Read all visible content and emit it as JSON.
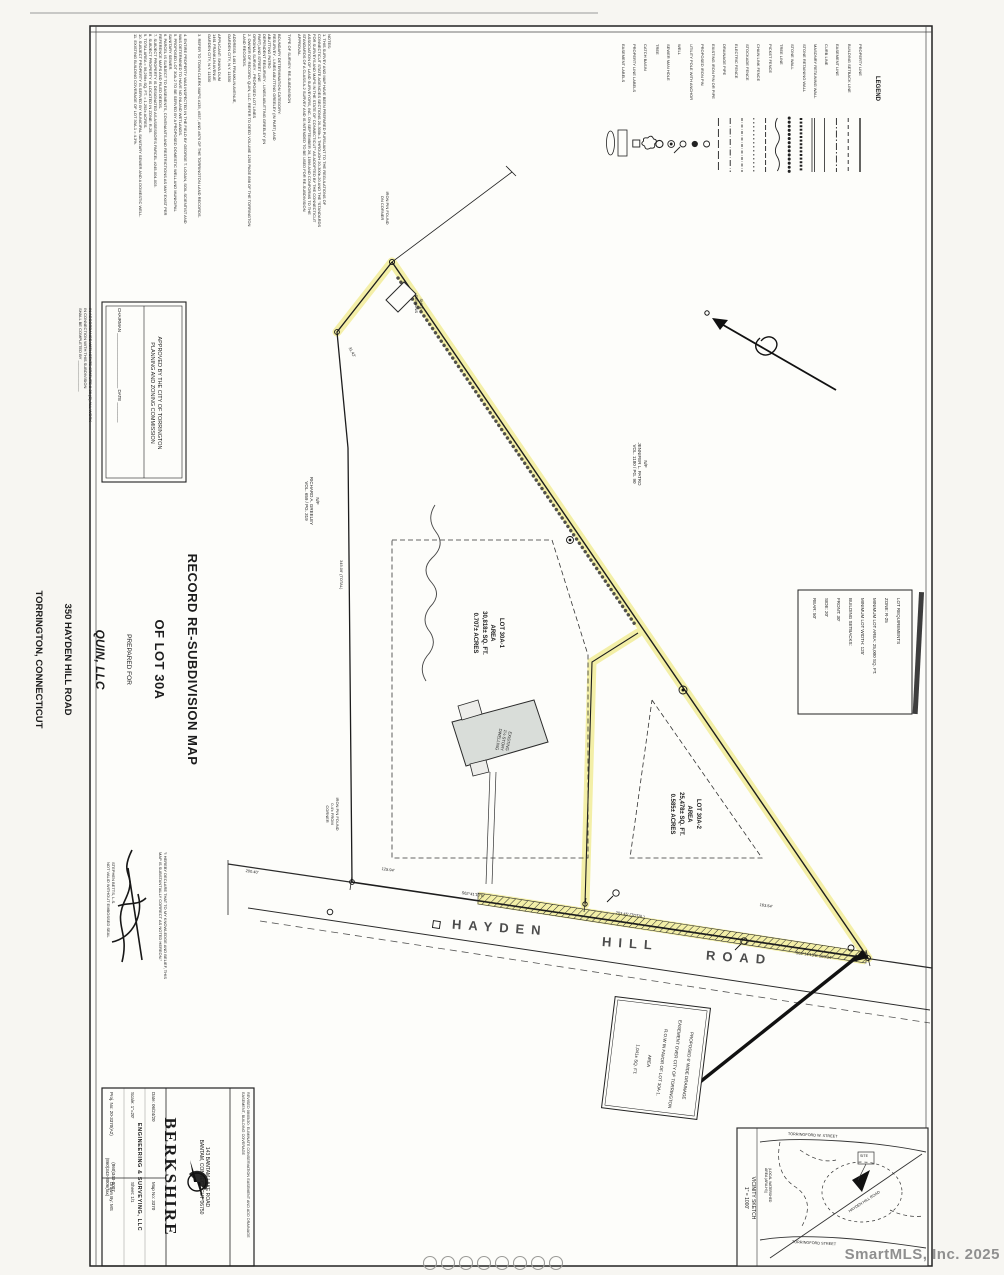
{
  "watermark": "SmartMLS, Inc.  2025",
  "title": {
    "line1": "RECORD RE-SUBDIVISION MAP",
    "line2": "OF LOT 30A",
    "prepared_for": "PREPARED FOR",
    "owner": "QUIN, LLC",
    "address": "350 HAYDEN HILL ROAD",
    "city": "TORRINGTON, CONNECTICUT"
  },
  "legend": {
    "title": "LEGEND",
    "items": "PROPERTY LINE\nBUILDING SETBACK LINE\nEASEMENT LINE\nCURB LINE\nMASONRY RETAINING WALL\nSTONE RETAINING WALL\nSTONE WALL\nTREE LINE\nPICKET FENCE\nCHAIN LINK FENCE\nSTOCKADE FENCE\nELECTRIC FENCE\nDRAINAGE PIPE\nEXISTING IRON PIN OR PIPE\nPROPOSED IRON PIN\nUTILITY POLE WITH ANCHOR\nWELL\nSEWER MAN HOLE\nTREE\nCATCH BASIN\nPROPERTY LINE LABELS\nEASEMENT LABELS"
  },
  "notes_col1": "NOTES:\n1. THIS SURVEY AND MAP HAVE BEEN PREPARED PURSUANT TO THE REGULATIONS OF\nCONNECTICUT STATE AGENCIES SECTIONS 20-300b-1 THROUGH 20-300b-20 AND THE \"STANDARDS\nFOR SURVEYS AND MAPS IN THE STATE OF CONNECTICUT\" AS ADOPTED BY THE CONNECTICUT\nASSOCIATION OF LAND SURVEYORS, INC. ON SEPTEMBER 26, 1996 AND CONFORMS TO THE\nSTANDARDS OF A CLASS A-2 SURVEY AND IS INTENDED TO BE USED FOR RE-SUBDIVISION\nAPPROVAL.\n\nTYPE OF SURVEY:   RE-SUBDIVISION\n\nBOUNDARY DETERMINATION CATEGORY:\n        RESURVEY - LINES ABUTTING GREELEY (IN PART) AND\n        ABUTTING PATRO\n        DEPENDENT RESURVEY - LINES ABUTTING GREELEY (IN\n        PART) AND STREET LINE\n        ORIGINAL SURVEY - PROPOSED LOT LINES",
  "notes_col2": "2. OWNER OF RECORD:  QUIN, LLC. REFER TO DEED VOLUME 1295 PAGE 898 OF THE TORRINGTON\nLAND RECORDS.\n\n        ADDRESS:  1461 FRANKLIN AVENUE,\n        GARDEN CITY, N.Y. 11530\n\n        APPLICANT:  SHAYA DUM\n        1461 FRANKLIN AVENUE\n        GARDEN CITY, N.Y. 11530\n\n3. REFER TO TOWN CLERK MAPS #135, #537, AND #879 OF THE TORRINGTON LAND RECORDS.",
  "notes_col3": "4. ENTIRE PROPERTY WAS INSPECTED IN THE FIELD BY GEORGE T. LOGAN, SOIL SCIENTIST AND\nWAS DETERMINED TO HAVE NO INLAND WETLANDS.\n5. PROPOSED LOT 30A-2 TO BE SERVED BY A PROPOSED DOMESTIC WELL AND MUNICIPAL\nSANITARY SEWER.\n6. PARCEL IS SUBJECT TO EASEMENTS, COVENANTS AND RESTRICTIONS AS MAY EXIST PER\nREFERENCE MAPS AND FILED DEEDS.\n7. SUBJECT PROPERTY IS DESIGNATED AS ASSESSOR'S PARCEL #245-004-003.\n8. SUBJECT PROPERTY IS LOCATED IN ZONE: R-25.\n9. TOTAL AREA = 56,296± SQ. FT. = 1.292± ACRES.\n10. SUBJECT PROPERTY IS SERVED BY MUNICIPAL SANITARY SEWER AND A DOMESTIC WELL.\n11. EXISTING BUILDING COVERAGE OF LOT 30A-1 = 4.3%.",
  "approval": {
    "title": "APPROVED BY THE CITY OF TORRINGTON\nPLANNING AND ZONING COMMISSION",
    "signline": "CHAIRMAN ______________________        DATE ________",
    "note": "IN ACCORDANCE WITH STATE STATUTE 8-26 (C) ALL WORK\nIN CONNECTION WITH THIS SUBDIVISION\nSHALL BE COMPLETED BY ______________"
  },
  "certification": {
    "declaration": "\"I HEREBY DECLARE THAT TO MY KNOWLEDGE AND BELIEF, THIS\nMAP IS SUBSTANTIALLY CORRECT AS NOTED HEREON.\"",
    "name_seal": "STEPHEN BETTS, L.S.\nNOT VALID WITHOUT EMBOSSED SEAL"
  },
  "lot1": "LOT 30A-1\nAREA\n30,818± SQ. FT.\n0.707± ACRES",
  "lot2": "LOT 30A-2\nAREA\n25,478± SQ. FT.\n0.585± ACRES",
  "requirements": "LOT REQUIREMENTS\nZONE:  R-25\nMINIMUM LOT AREA: 25,000 SQ. FT.\nMINIMUM LOT WIDTH: 125'\nBUILDING SETBACKS:\n    FRONT:  30'\n    SIDE:  20'\n    REAR:  50'",
  "drainage_note": "PROPOSED 6' WIDE DRAINAGE\nEASEMENT OVER CITY OF TORRINGTON\nR.O.W IN FAVOR OF LOT 30A-1.\nAREA\n1,041± SQ. FT.",
  "abutters": {
    "patro": "N/F\nJENNIFER L. PATRO\nVOL. 1180 / PG. 90",
    "greeley": "N/F\nRICHARD A. GREELEY\nVOL. 659 / PG. 319"
  },
  "features": {
    "dwelling": "EXISTING\n1½ STORY\nDWELLING",
    "shed": "SHED\nREMAINS",
    "iron_pin_top": "IRON PIN FOUND\nON CORNER",
    "iron_pin_road": "IRON PIN FOUND\n0.4'± FROM\nCORNER"
  },
  "road": {
    "w1": "HAYDEN",
    "w2": "HILL",
    "w3": "ROAD"
  },
  "bearings": {
    "b1": "S62°41'10\"E",
    "d_total": "203.45'  (TOTAL)",
    "d2": "163.54'",
    "b2": "S63°14'15\"E   103.34'",
    "d3": "125.94'",
    "d4": "200.40'",
    "d5": "345.06'  (TOTAL)",
    "d6": "31.42'"
  },
  "titleblock": {
    "revision": "REVISED 08/05/20:  ELIMINATE CONSERVATION EASEMENT AND ADD DRAINAGE\nEASEMENT, BUILDING COVERAGE",
    "addr": "143 BANTAM LAKE ROAD\nBANTAM, CONNECTICUT 06750",
    "firm": "BERKSHIRE",
    "firm2": "ENGINEERING & SURVEYING, LLC",
    "phones": "(860)343-8007\n(860)343-8006(fax)",
    "col1": "Date:   06/24/20\nScale:   1\"=20'\nProj. No:   20-3370(A2)",
    "col2": "Map No:   3370\nSheet:   1/1\nDrawn By:   MS"
  },
  "vicinity": {
    "title": "VICINITY SKETCH\n1\" = 1000'",
    "street_top": "TORRINGFORD  W.  STREET",
    "street_bottom": "TORRINGFORD  STREET",
    "road": "HAYDEN HILL ROAD",
    "site": "SITE",
    "watershed": "(LOCAL WATERSHED\nAREA (ARA-HI))"
  }
}
